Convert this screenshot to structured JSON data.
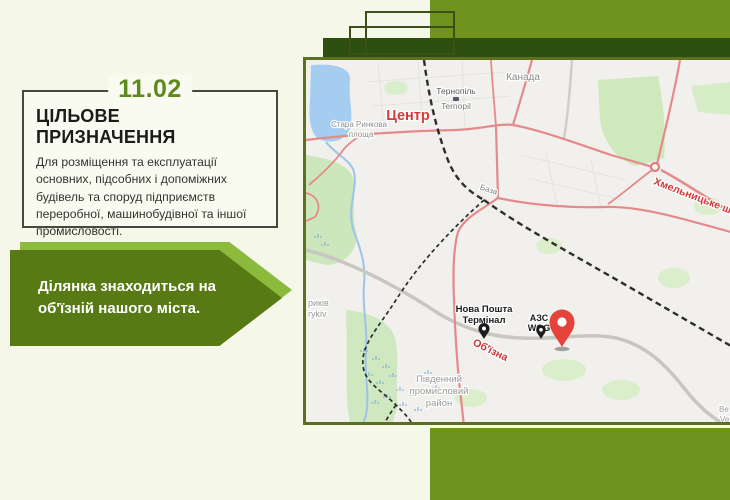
{
  "slide": {
    "number": "11.02",
    "title": "ЦІЛЬОВЕ ПРИЗНАЧЕННЯ",
    "description": "Для розміщення та експлуатації основних, підсобних і допоміжних будівель та споруд підприємств переробної, машинобудівної та іншої промисловості.",
    "callout": "Ділянка знаходиться на об'їзній нашого міста."
  },
  "map": {
    "labels": {
      "district_top": "Канада",
      "center": "Центр",
      "station_ua": "Тернопіль",
      "station_en": "Ternopil",
      "square_line1": "Стара Ринкова",
      "square_line2": "площа",
      "base": "База",
      "highway": "Хмельницьке шосе",
      "bypass": "Об'їзна",
      "nova_poshta_line1": "Нова Пошта",
      "nova_poshta_line2": "Термінал",
      "gas_line1": "АЗС",
      "gas_line2": "WOG",
      "industrial_line1": "Південний",
      "industrial_line2": "промисловий",
      "industrial_line3": "район",
      "village_ua": "риків",
      "village_en": "rykiv",
      "edge_ua": "Ве",
      "edge_en": "Ve"
    },
    "colors": {
      "marker": "#e5433c",
      "road_red": "#e58a8a",
      "road_label": "#d43a3a",
      "water": "#a5cdf0",
      "park": "#cfe9bd",
      "railway": "#2e2e2e"
    }
  },
  "theme": {
    "background": "#f5f7e9",
    "olive": "#70931d",
    "dark_green": "#2d5010",
    "arrow_dark": "#587a14",
    "arrow_light": "#8cba3d",
    "accent_number": "#5d8a1f"
  }
}
